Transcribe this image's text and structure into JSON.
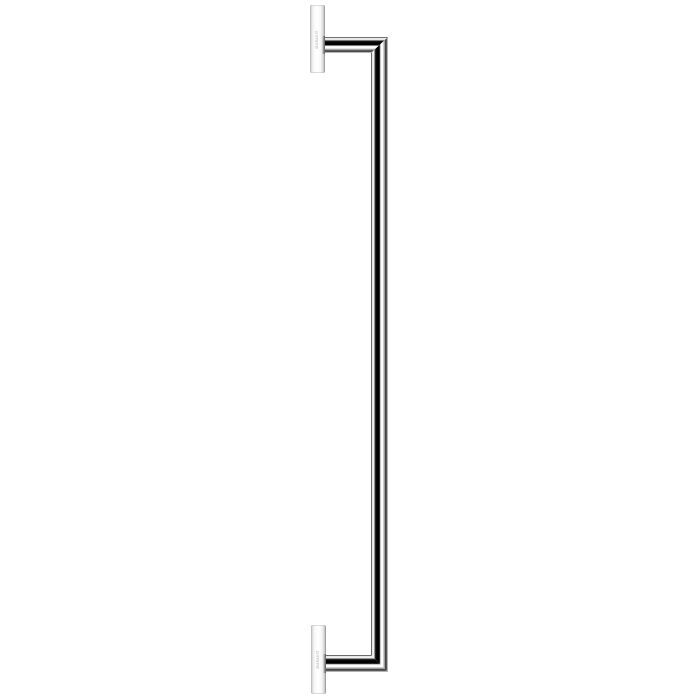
{
  "image": {
    "background_color": "#ffffff"
  },
  "product": {
    "brand_label": "DURAVIT",
    "finish": {
      "chrome_dark_band": "#050505",
      "chrome_highlight": "#ffffff",
      "chrome_mid_gray": "#8c8c8c",
      "chrome_edge_line": "#444444",
      "plate_face": "#ffffff",
      "plate_edge": "#aeaeae"
    }
  }
}
